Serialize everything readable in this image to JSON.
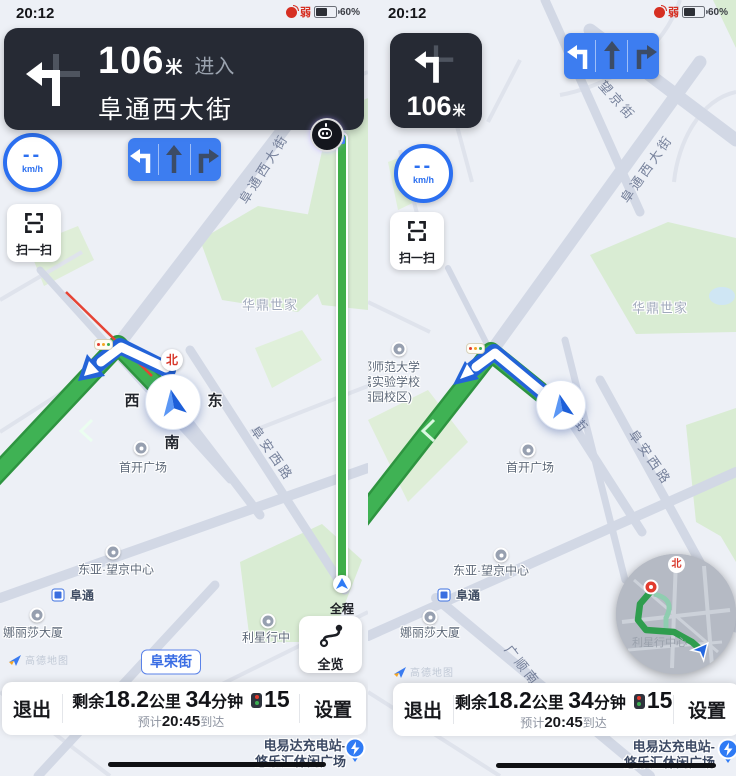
{
  "colors": {
    "accent_blue": "#2f7bf5",
    "route_green": "#3cae52",
    "banner_dark": "#262a34",
    "lane_blue": "#3d7df0",
    "alert_red": "#e64334",
    "map_bg": "#edf0f6"
  },
  "status_bar": {
    "time": "20:12",
    "signal_label": "弱",
    "battery_percent": "60%"
  },
  "banner": {
    "distance": "106",
    "distance_unit": "米",
    "action": "进入",
    "road_name": "阜通西大街"
  },
  "turn_card": {
    "distance": "106",
    "distance_unit": "米"
  },
  "speed_dial": {
    "value": "--",
    "unit": "km/h"
  },
  "scan_button": {
    "label": "扫一扫"
  },
  "progress_bar": {
    "label": "全程"
  },
  "overview_button": {
    "label": "全览"
  },
  "compass": {
    "north": "北",
    "west": "西",
    "east": "东",
    "south": "南"
  },
  "bottom_bar": {
    "exit_label": "退出",
    "remaining_prefix": "剩余",
    "distance_value": "18.2",
    "distance_unit": "公里",
    "duration_value": "34",
    "duration_unit": "分钟",
    "traffic_light_count": "15",
    "eta_prefix": "预计",
    "eta_time": "20:45",
    "eta_suffix": "到达",
    "settings_label": "设置"
  },
  "attribution": {
    "label": "高德地图"
  },
  "charging_poi": {
    "line1": "电易达充电站-",
    "line2": "悠乐汇休闲广场"
  },
  "minimap": {
    "north_label": "北",
    "poi_label": "利星行中心"
  },
  "map_labels": {
    "left": {
      "futong_west_street": "阜通西大街",
      "huading_shijia": "华鼎世家",
      "shoukai_plaza": "首开广场",
      "fuan_west_road": "阜安西路",
      "dongya_wangjing_center": "东亚·望京中心",
      "futong_station": "阜通",
      "nalisha_building": "娜丽莎大厦",
      "lixingxing_center": "利星行中",
      "furong_street": "阜荣街"
    },
    "right": {
      "wangjing_street": "望京街",
      "futong_west_street": "阜通西大街",
      "huading_shijia": "华鼎世家",
      "school_line1": "都师范大学",
      "school_line2": "属实验学校",
      "school_line3": "西园校区)",
      "shoukai_plaza": "首开广场",
      "fuan_west_road": "阜安西路",
      "street_partial": "街",
      "dongya_wangjing_center": "东亚·望京中心",
      "futong_station": "阜通",
      "nalisha_building": "娜丽莎大厦",
      "guangshun_south": "广顺南"
    }
  }
}
